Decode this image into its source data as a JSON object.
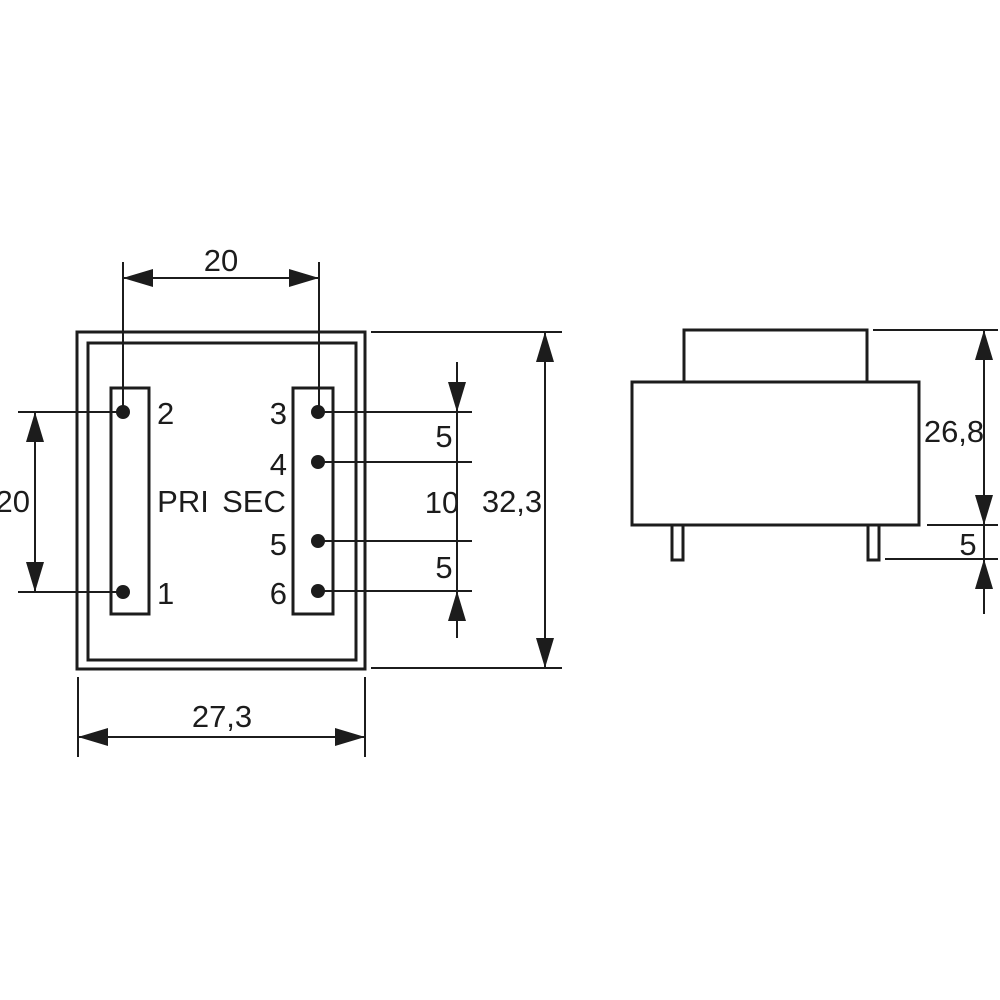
{
  "colors": {
    "background": "#ffffff",
    "line": "#1c1c1c"
  },
  "top_view": {
    "winding_left_label": "PRI",
    "winding_right_label": "SEC",
    "pin1": "1",
    "pin2": "2",
    "pin3": "3",
    "pin4": "4",
    "pin5": "5",
    "pin6": "6"
  },
  "dimensions": {
    "pin_column_spacing": "20",
    "pri_pin_pitch": "20",
    "body_width": "27,3",
    "body_depth": "32,3",
    "sec_pitch_3_4": "5",
    "sec_pitch_4_5": "10",
    "sec_pitch_5_6": "5",
    "side_height": "26,8",
    "side_pin_length": "5"
  }
}
